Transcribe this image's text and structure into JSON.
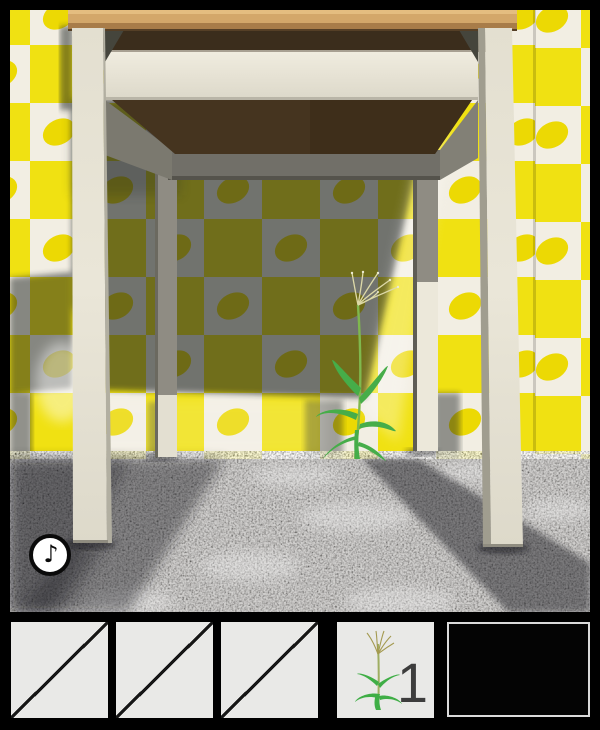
{
  "window": {
    "width": 600,
    "height": 730,
    "frame_color": "#000000"
  },
  "scene": {
    "description": "room corner viewed from floor level: wooden-top table with cream legs in front of yellow-and-white lemon-pattern checkered wallpaper, grey speckled carpet, grass weed growing under the table",
    "hotspots": [
      "table",
      "grass-plant",
      "wallpaper",
      "carpet"
    ],
    "music_button": {
      "glyph": "♪",
      "icon": "music-note-icon",
      "state": "on"
    }
  },
  "inventory": {
    "slots": [
      {
        "id": 1,
        "state": "empty"
      },
      {
        "id": 2,
        "state": "empty"
      },
      {
        "id": 3,
        "state": "empty"
      },
      {
        "id": 4,
        "state": "item",
        "item": "grass-plant",
        "count": "1"
      },
      {
        "id": 5,
        "state": "item-view-empty"
      }
    ]
  },
  "colors": {
    "tile_yellow": "#f0e112",
    "tile_white": "#f2eee3",
    "lemon": "#ecd904",
    "shadow_overlay": "#1e2024",
    "wood_top": "#d3a76a",
    "wood_edge": "#a87c49",
    "table_underside": "#45341f",
    "apron_cream": "#efebde",
    "leg_cream": "#e9e5d7",
    "carpet_grey": "#8f8d89",
    "plant_green": "#46ad49",
    "seed_head": "#ddd9a8",
    "slot_bg": "#e9e9e7",
    "count_text": "#3d3d3d"
  }
}
